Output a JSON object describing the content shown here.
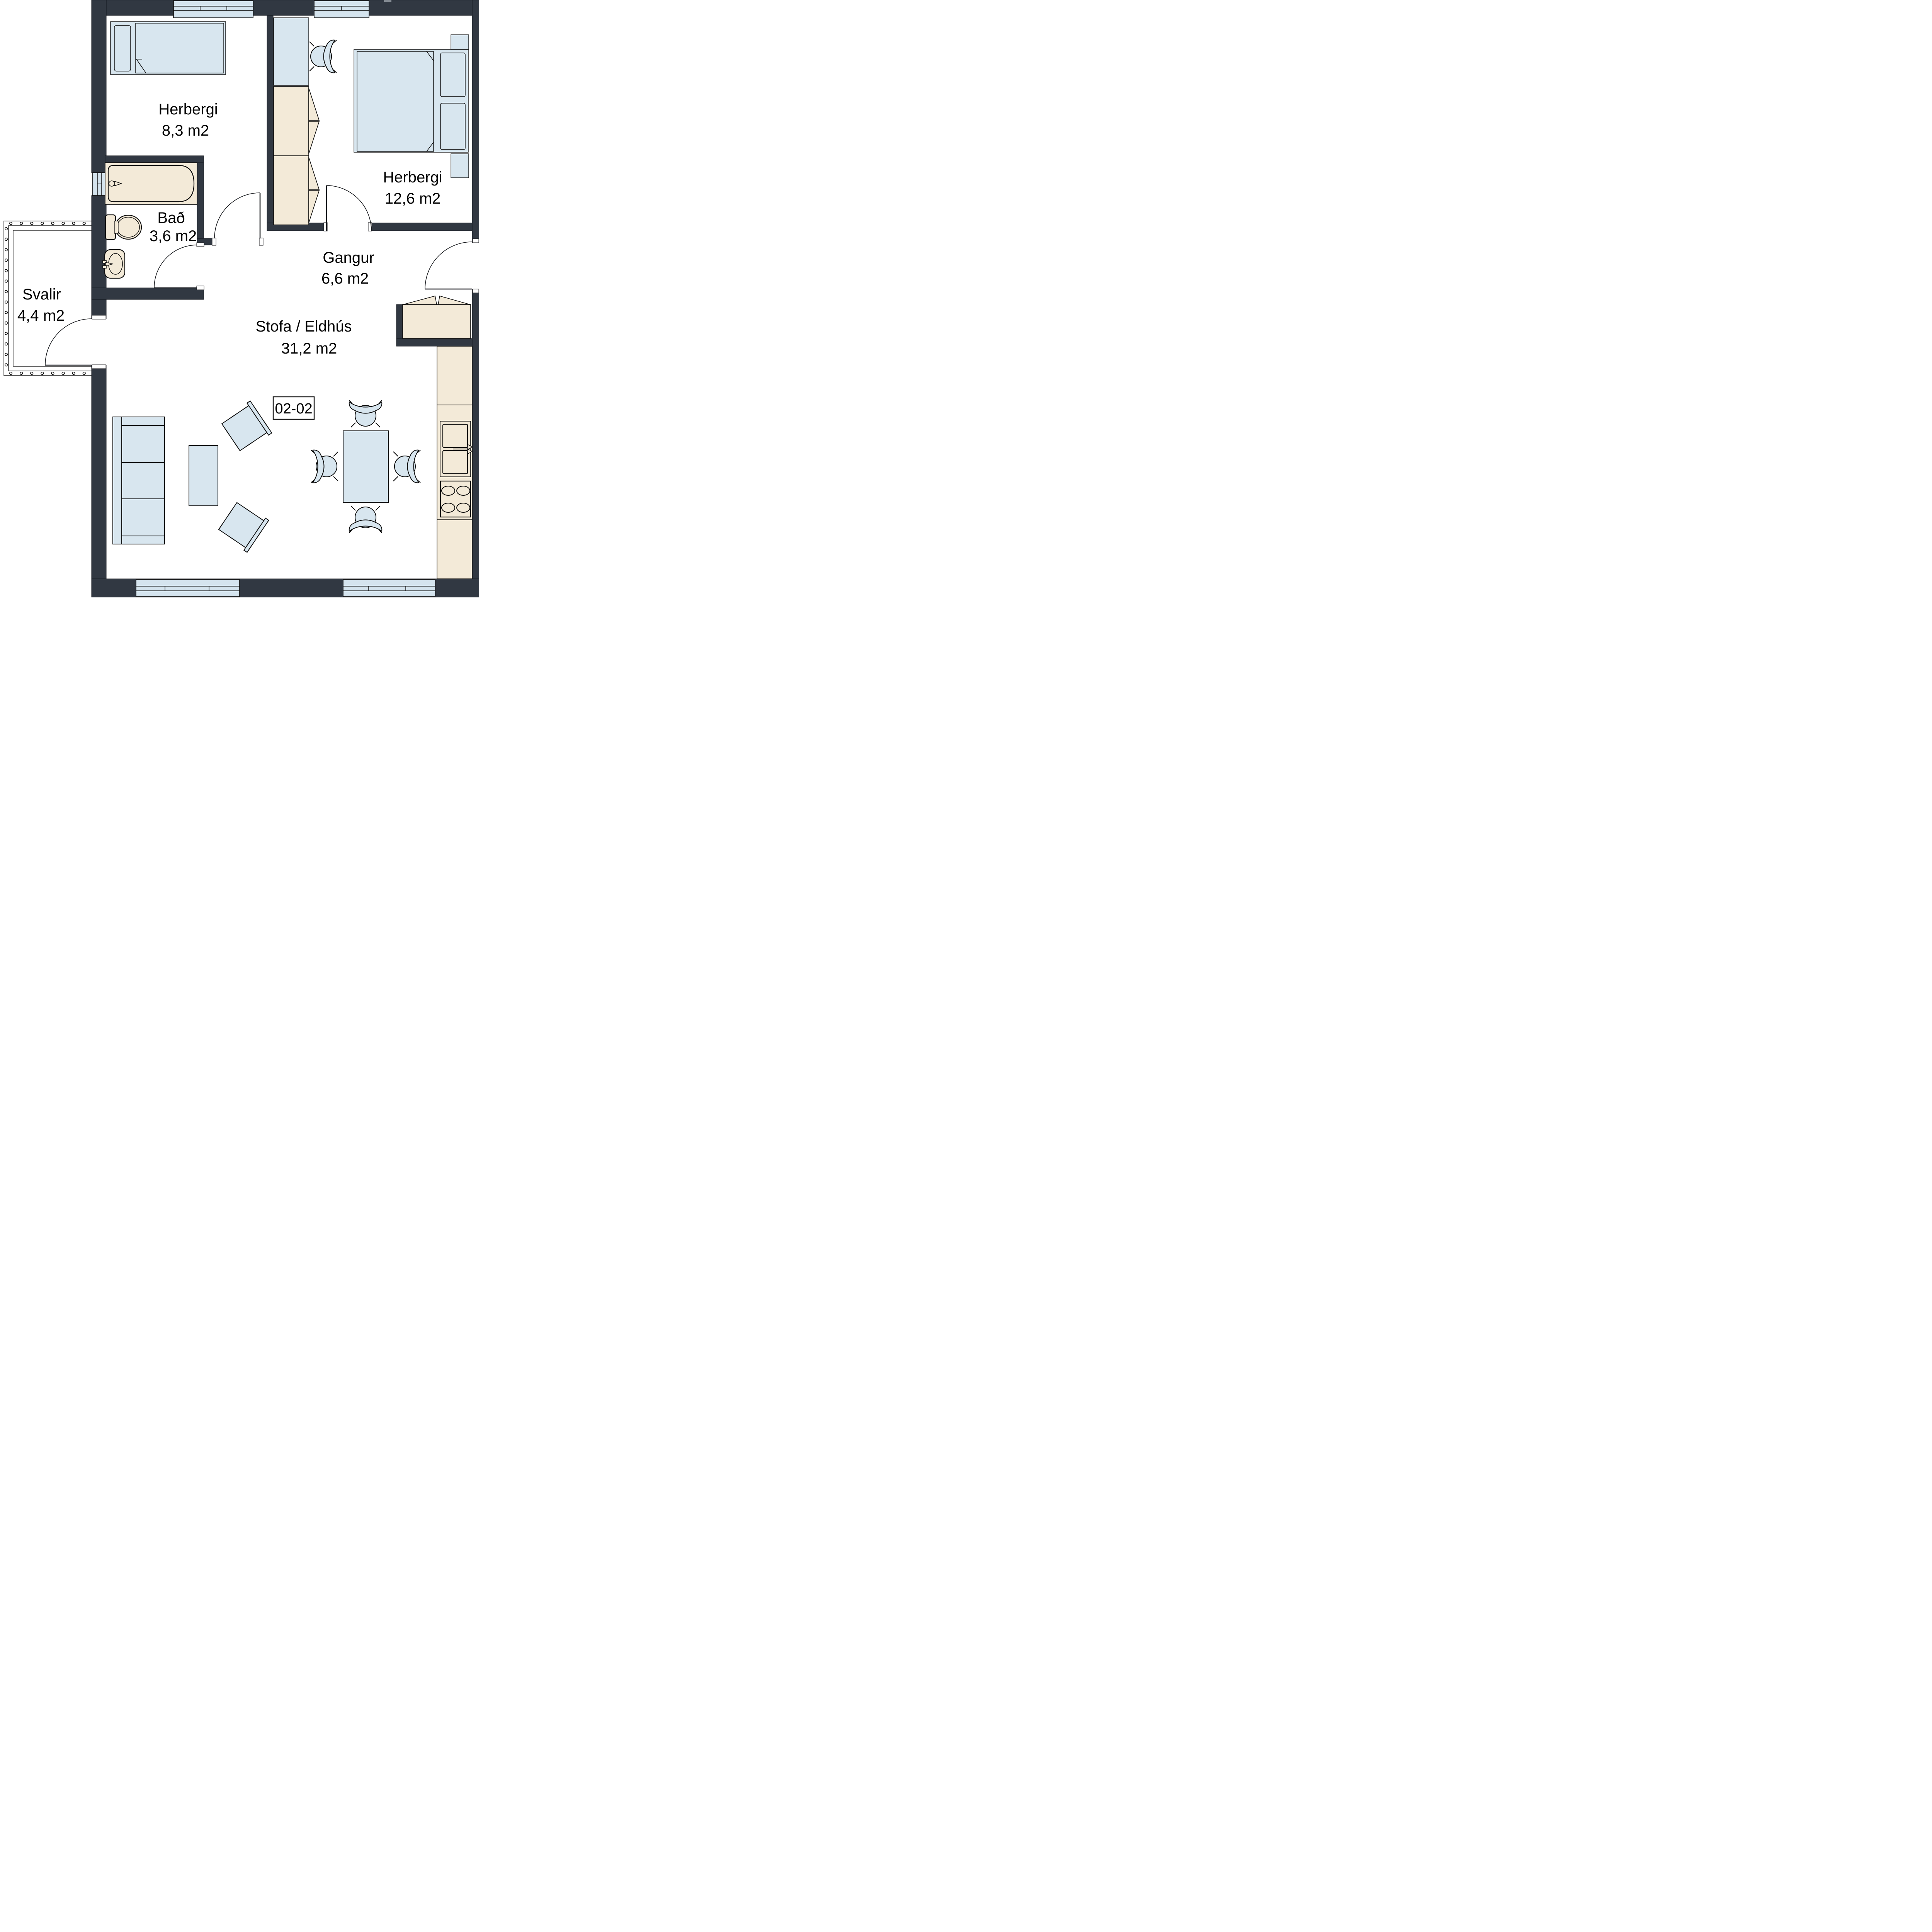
{
  "plan": {
    "type": "apartment-floor-plan",
    "apartment_number": "02-02",
    "rooms": [
      {
        "id": "herbergi-1",
        "name": "Herbergi",
        "area": "8,3 m2"
      },
      {
        "id": "herbergi-2",
        "name": "Herbergi",
        "area": "12,6 m2"
      },
      {
        "id": "bad",
        "name": "Bað",
        "area": "3,6 m2"
      },
      {
        "id": "gangur",
        "name": "Gangur",
        "area": "6,6 m2"
      },
      {
        "id": "stofa-eldhus",
        "name": "Stofa / Eldhús",
        "area": "31,2 m2"
      },
      {
        "id": "svalir",
        "name": "Svalir",
        "area": "4,4 m2"
      }
    ],
    "colors": {
      "wall": "#313842",
      "furniture_blue": "#d8e6ef",
      "window_blue": "#d5e4ee",
      "fixture_cream": "#f3ead8",
      "outline": "#0c0c0c",
      "background": "#ffffff"
    },
    "furniture": [
      "single-bed",
      "double-bed",
      "desk",
      "desk-chair",
      "wardrobe",
      "bathtub",
      "toilet",
      "washbasin",
      "hall-closet",
      "kitchen-counter",
      "kitchen-sink",
      "stove",
      "dining-table",
      "dining-chairs",
      "sofa",
      "coffee-table",
      "armchairs",
      "balcony-railing"
    ]
  }
}
